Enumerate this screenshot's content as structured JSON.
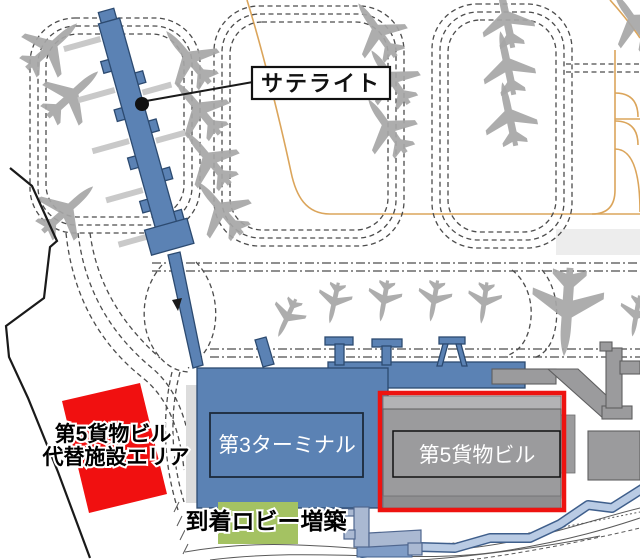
{
  "map": {
    "callout": {
      "satellite": "サテライト"
    },
    "buildings": {
      "terminal3": "第3ターミナル",
      "cargo5": "第5貨物ビル"
    },
    "annotations": {
      "replacement_area_line1": "第5貨物ビル",
      "replacement_area_line2": "代替施設エリア",
      "arrival_lobby": "到着ロビー増築"
    },
    "colors": {
      "terminal_blue": "#5b82b4",
      "building_gray": "#9b9b9d",
      "highlight_red": "#ee1310",
      "highlight_green": "#a4c262",
      "guideline_orange": "#dba55b",
      "airplane_gray": "#a6a6a6",
      "road_blue": "#b9cbe4",
      "boundary_black": "#1a1a1a"
    }
  }
}
